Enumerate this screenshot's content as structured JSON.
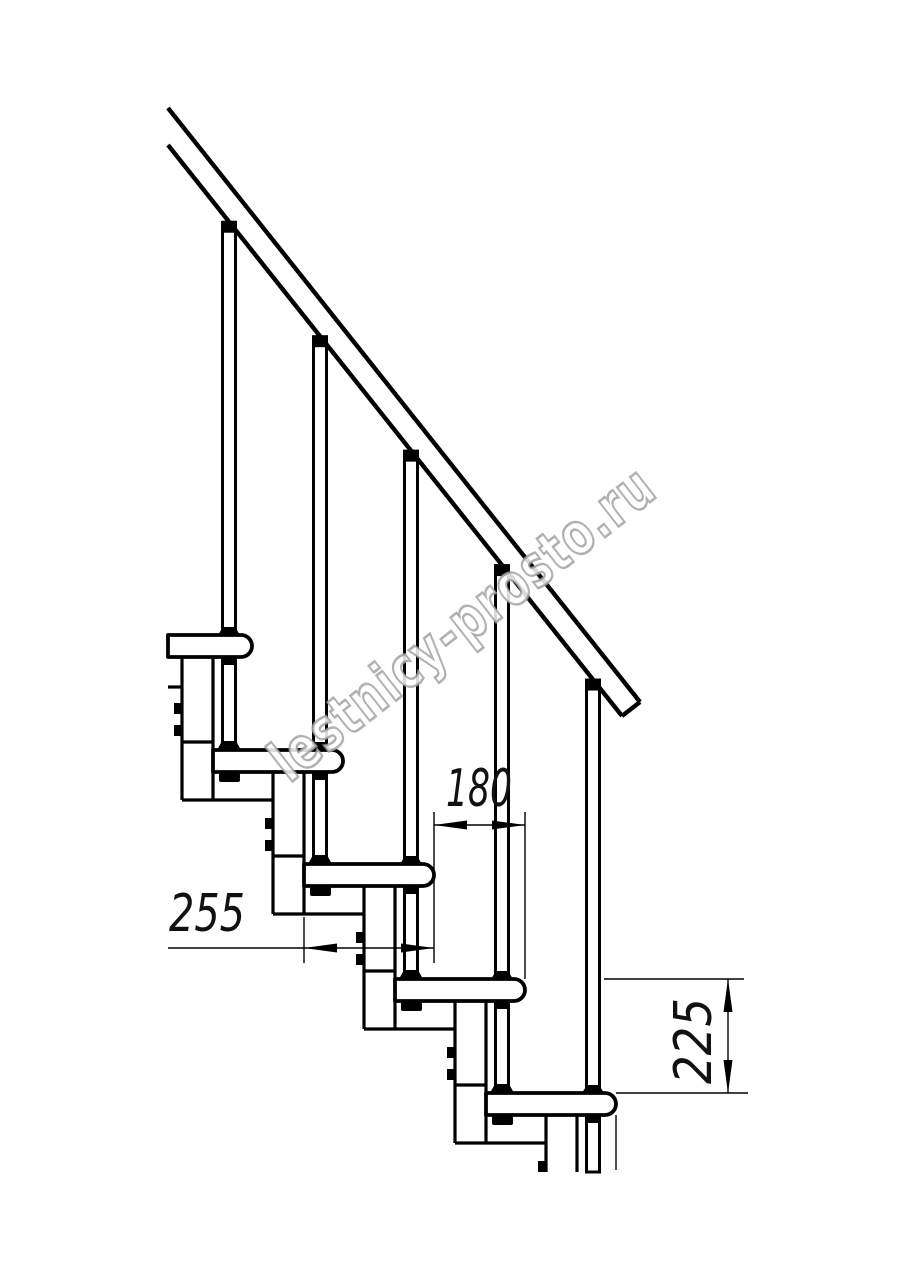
{
  "page": {
    "background": "#ffffff"
  },
  "watermark": {
    "text": "lestnicy-prosto.ru",
    "outline_color": "#9e9e9e",
    "fill_color": "#ffffff",
    "angle_deg": -38
  },
  "dimension_labels": {
    "going": "180",
    "depth": "255",
    "rise": "225"
  },
  "dimensions_mm": {
    "step_going": 180,
    "tread_depth": 255,
    "step_rise": 225
  },
  "stair": {
    "ink": "#000000",
    "steps": 5,
    "first_tread": {
      "left": 122,
      "top": 635
    },
    "step_dx": 91,
    "step_dy": 114.5,
    "tread_len": 130,
    "tread_h": 22,
    "tip_radius": 11,
    "left_cut_x": 168,
    "bottom_cut_y": 1172,
    "baluster_offset": 107,
    "baluster_w": 13,
    "module_offset": 60,
    "module_w": 31,
    "rail": {
      "upper": [
        168,
        108,
        640,
        702
      ],
      "lower": [
        168,
        145,
        622,
        716
      ]
    },
    "dims": {
      "going": {
        "line_y": 825,
        "ext_top_y": 812
      },
      "depth": {
        "line_y": 948,
        "tail_x": 168,
        "ext1_top_y": 917,
        "ext_bot_y": 963
      },
      "rise": {
        "line_x": 728,
        "ext_top": [
          604,
          744
        ],
        "ext_bot": [
          616,
          748
        ]
      }
    }
  }
}
